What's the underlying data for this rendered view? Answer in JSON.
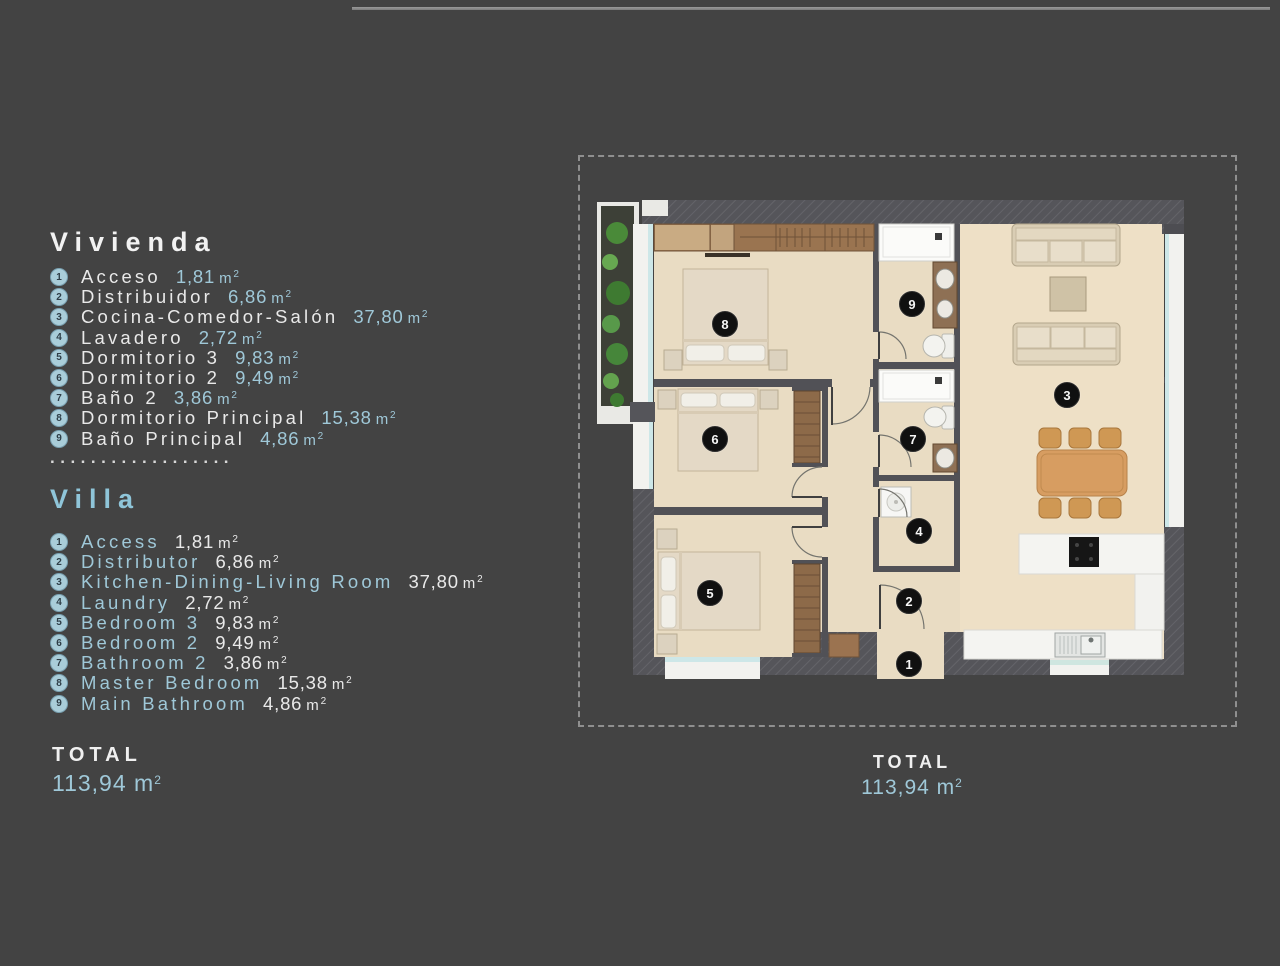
{
  "units": {
    "m": "m",
    "sup": "2"
  },
  "legend": {
    "separator": "..................",
    "sections": [
      {
        "title": "Vivienda",
        "items": [
          {
            "n": "1",
            "label": "Acceso",
            "value": "1,81"
          },
          {
            "n": "2",
            "label": "Distribuidor",
            "value": "6,86"
          },
          {
            "n": "3",
            "label": "Cocina-Comedor-Salón",
            "value": "37,80"
          },
          {
            "n": "4",
            "label": "Lavadero",
            "value": "2,72"
          },
          {
            "n": "5",
            "label": "Dormitorio 3",
            "value": "9,83"
          },
          {
            "n": "6",
            "label": "Dormitorio 2",
            "value": "9,49"
          },
          {
            "n": "7",
            "label": "Baño 2",
            "value": "3,86"
          },
          {
            "n": "8",
            "label": "Dormitorio Principal",
            "value": "15,38"
          },
          {
            "n": "9",
            "label": "Baño Principal",
            "value": "4,86"
          }
        ]
      },
      {
        "title": "Villa",
        "items": [
          {
            "n": "1",
            "label": "Access",
            "value": "1,81"
          },
          {
            "n": "2",
            "label": "Distributor",
            "value": "6,86"
          },
          {
            "n": "3",
            "label": "Kitchen-Dining-Living Room",
            "value": "37,80"
          },
          {
            "n": "4",
            "label": "Laundry",
            "value": "2,72"
          },
          {
            "n": "5",
            "label": "Bedroom 3",
            "value": "9,83"
          },
          {
            "n": "6",
            "label": "Bedroom 2",
            "value": "9,49"
          },
          {
            "n": "7",
            "label": "Bathroom 2",
            "value": "3,86"
          },
          {
            "n": "8",
            "label": "Master Bedroom",
            "value": "15,38"
          },
          {
            "n": "9",
            "label": "Main Bathroom",
            "value": "4,86"
          }
        ]
      }
    ],
    "total": {
      "label": "TOTAL",
      "value": "113,94"
    }
  },
  "plan": {
    "markers": [
      {
        "n": "1"
      },
      {
        "n": "2"
      },
      {
        "n": "3"
      },
      {
        "n": "4"
      },
      {
        "n": "5"
      },
      {
        "n": "6"
      },
      {
        "n": "7"
      },
      {
        "n": "8"
      },
      {
        "n": "9"
      }
    ],
    "total": {
      "label": "TOTAL",
      "value": "113,94"
    }
  },
  "colors": {
    "background": "#434343",
    "accent_blue": "#8fc5d9",
    "text_white": "#e9e9e9",
    "badge_bg": "#a9cdd9",
    "marker_bg": "#101010",
    "floor_beige": "#e9dcc3",
    "wall_dark": "#55555a"
  }
}
